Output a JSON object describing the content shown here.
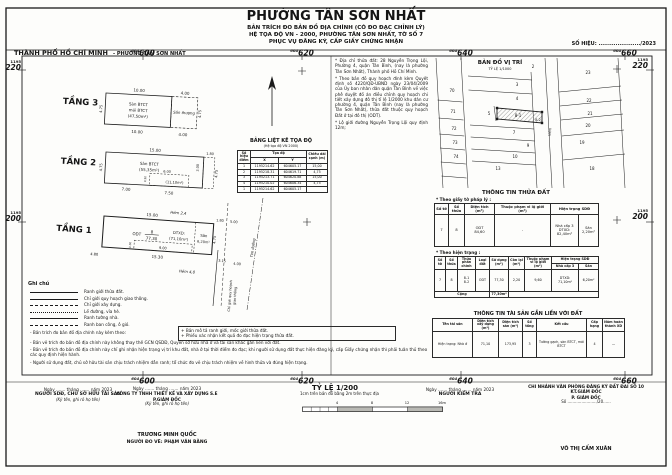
{
  "header": {
    "ward_title": "PHƯỜNG TÂN SƠN NHẤT",
    "subtitle1": "BẢN TRÍCH ĐO BẢN ĐỒ ĐỊA CHÍNH (CÓ ĐO ĐẠC CHỈNH LÝ)",
    "subtitle2": "HỆ TỌA ĐỘ VN - 2000, PHƯỜNG TÂN SƠN NHẤT, TỜ SỐ 7",
    "subtitle3": "PHỤC VỤ ĐĂNG KÝ, CẤP GIẤY CHỨNG NHẬN",
    "city": "THÀNH PHỐ HỒ CHÍ MINH",
    "city_suffix": "-  PHƯỜNG TÂN SƠN NHẤT",
    "doc_no": "SỐ HIỆU: ....................../2023"
  },
  "frame": {
    "tick_prefix": "604",
    "ticks": [
      "600",
      "620",
      "640",
      "660"
    ],
    "row_prefix": "1195",
    "rows": [
      "220",
      "200"
    ]
  },
  "floors": {
    "f3": {
      "label": "TẦNG 3",
      "l1": "Sàn BTCT",
      "l2": "mái BTCT",
      "l3": "(47,50m²)",
      "annex": "Sân thượng",
      "d_top1": "10.00",
      "d_top2": "4.00",
      "d_bot1": "10.00",
      "d_bot2": "4.00",
      "d_left": "4.75",
      "d_right": "4.75"
    },
    "f2": {
      "label": "TẦNG 2",
      "l1": "Sàn BTCT",
      "l2": "(55,35m²)",
      "void_area": "(11,10m²)",
      "d_top": "15.00",
      "d_top2": "1.80",
      "d_void": "6.00",
      "d_bot1": "7.00",
      "d_bot2": "7.50",
      "d_left": "4.75",
      "d_right": "4.75",
      "d_r2": "3.00",
      "d_small": "0.30"
    },
    "f1": {
      "label": "TẦNG 1",
      "odt": "ODT",
      "lot_no": "8",
      "lot_area": "77,30",
      "dtxd1": "DTXD:",
      "dtxd2": "(71,10m²)",
      "san1": "Sân",
      "san2": "6,20m²",
      "d_top": "15.00",
      "d_top2": "1.80",
      "d_top3": "5.00",
      "d_bot0": "4.80",
      "d_bot1": "15.30",
      "d_bot2": "3.15",
      "d_bot3": "4.00",
      "d_right": "4.75",
      "d_in": "9.00",
      "d_in2": "0.30",
      "alley_top": "Hẻm 2,4",
      "alley_bot": "Hẻm 4,0",
      "cgqh1": "Chỉ giới quy hoạch",
      "cgqh2": "giao thông",
      "tim": "Tim đường"
    }
  },
  "coord_table": {
    "title": "BẢNG LIỆT KÊ TỌA ĐỘ",
    "subtitle": "(Hệ tọa độ VN 2000)",
    "h_point": "Số hiệu điểm",
    "h_coord": "Tọa độ",
    "h_x": "X",
    "h_y": "Y",
    "h_len": "Chiều dài cạnh (m)",
    "rows": [
      [
        "1",
        "1195214.62",
        "604605.17",
        "15,00"
      ],
      [
        "2",
        "1195218.31",
        "604619.71",
        "4,75"
      ],
      [
        "3",
        "1195213.71",
        "604620.88",
        "15,00"
      ],
      [
        "4",
        "1195210.02",
        "604606.34",
        "4,75"
      ],
      [
        "1",
        "1195214.62",
        "604605.17",
        ""
      ]
    ]
  },
  "notes_right": {
    "n1": "* Địa chỉ thửa đất: 28 Nguyễn Trọng Lội, Phường 4, quận Tân Bình, (nay là phường Tân Sơn Nhất), Thành phố Hồ Chí Minh.",
    "n2": "* Theo bản đồ quy hoạch đính kèm Quyết định số 4220/QĐ-UBND ngày 23/04/2009 của Ủy ban nhân dân quận Tân Bình về việc phê duyệt đồ án điều chỉnh quy hoạch chi tiết xây dựng đô thị tỉ lệ 1/2000 khu dân cư phường 4, quận Tân Bình (nay là phường Tân Sơn Nhất), thửa đất thuộc quy hoạch Đất ở tại đô thị (ODT).",
    "n3": "* Lộ giới đường Nguyễn Trọng Lội quy định 12m;"
  },
  "location_map": {
    "title": "BẢN ĐỒ VỊ TRÍ",
    "scale": "TỶ LỆ 1/1000",
    "street": "Hẻm",
    "parcels": {
      "p2": "2",
      "p3": "3",
      "p4": "4",
      "p5": "5",
      "p81": "8-1",
      "p82": "8-2",
      "p7": "7",
      "p9": "9",
      "p10": "10",
      "p13": "13",
      "p70": "70",
      "p71": "71",
      "p72": "72",
      "p73": "73",
      "p74": "74",
      "p23": "23",
      "p22": "22",
      "p21": "21",
      "p20": "20",
      "p19": "19",
      "p18": "18"
    }
  },
  "land_info": {
    "title": "THÔNG TIN THỬA ĐẤT",
    "legal_caption": "* Theo giấy tờ pháp lý :",
    "legal": {
      "headers": [
        "Số tờ",
        "Số thửa",
        "Diện tích (m²)",
        "Thuộc phạm vi lộ giới (m²)",
        "Hiện trạng SDĐ"
      ],
      "so_to": "7",
      "so_thua": "8",
      "loai": "ODT",
      "dien_tich": "84,60",
      "lo_gioi": "-",
      "ht_nha": "Nhà cấp 3\nDTXD:\n82,40m²",
      "ht_san": "Sân\n2,20m²"
    },
    "current_caption": "* Theo hiện trạng :",
    "current": {
      "h_so_to": "Số tờ",
      "h_so_thua": "Số thửa",
      "h_phan": "Thửa phân chính",
      "h_loai": "Loại đất",
      "h_su_dung": "Sử dụng (m²)",
      "h_con_lai": "Còn lại (m²)",
      "h_lo_gioi": "Thuộc phạm vi lộ giới (m²)",
      "h_ht": "Hiện trạng SDĐ",
      "h_nha": "Nhà cấp 3",
      "h_san": "Sân",
      "so_to": "7",
      "so_thua": "8",
      "phan": "8-1\n8-2",
      "loai": "ODT",
      "su_dung": "77,30",
      "con_lai": "2,20",
      "lo_gioi": "9,60",
      "ht_nha": "DTXD:\n71,10m²",
      "ht_san": "6,20m²",
      "total_label": "Cộng",
      "total_value": "77,30m²"
    }
  },
  "asset_info": {
    "title": "THÔNG TIN TÀI SẢN GẮN LIỀN VỚI ĐẤT",
    "headers": [
      "Tên tài sản",
      "Diện tích xây dựng (m²)",
      "Diện tích sàn (m²)",
      "Số tầng",
      "Kết cấu",
      "Cấp hạng",
      "Năm hoàn thành XD"
    ],
    "row": [
      "Hiện trạng: Nhà ở",
      "71,10",
      "173,95",
      "3",
      "Tường gạch, sàn BTCT, mái BTCT",
      "4",
      "—"
    ]
  },
  "legend": {
    "title": "Ghi chú",
    "items": [
      {
        "label": "Ranh giới thửa đất."
      },
      {
        "label": "Chỉ giới quy hoạch giao thông."
      },
      {
        "label": "Chỉ giới xây dựng."
      },
      {
        "label": "Lề đường, vỉa hè."
      },
      {
        "label": "Ranh tường nhà."
      },
      {
        "label": "Ranh ban công, ô gió."
      }
    ]
  },
  "notes_bottom": {
    "n1": "- Bản trích đo bản đồ địa chính này kèm theo:",
    "n1a": "+ Bản mô tả ranh giới, mốc giới thửa đất.",
    "n1b": "+ Phiếu xác nhận kết quả đo đạc hiện trạng thửa đất.",
    "n2": "- Bản vẽ trích đo bản đồ địa chính này không thay thế GCN QSDĐ, Quyền sở hữu nhà ở và tài sản khác gắn liền với đất.",
    "n3": "- Bản vẽ trích đo bản đồ địa chính này chỉ ghi nhận hiện trạng vị trí khu đất, nhà ở tại thời điểm đo đạc; khi người sử dụng đất thực hiện đăng ký, cấp Giấy chứng nhận thì phải tuân thủ theo các quy định hiện hành.",
    "n4": "- Người sử dụng đất, chủ sở hữu tài sản chịu trách nhiệm dẫn ranh; tổ chức đo vẽ chịu trách nhiệm về hình thửa và đúng hiện trạng."
  },
  "signatures": {
    "date1": "Ngày ....... tháng ....... năm 2023",
    "b1_title": "NGƯỜI SDĐ, CHỦ SỞ HỮU TÀI SẢN",
    "b1_sub": "(Ký tên, ghi rõ họ tên)",
    "date2": "Ngày ....... tháng ....... năm 2023",
    "b2_title": "CÔNG TY TNHH THIẾT KẾ VÀ XÂY DỰNG S.E",
    "b2_role": "P.GIÁM ĐỐC",
    "b2_sub": "(Ký tên, ghi rõ họ tên)",
    "b2_name": "TRƯƠNG MINH QUỐC",
    "b2_surveyor": "NGƯỜI ĐO VẼ: PHẠM VĂN BẰNG",
    "date3": "Ngày ....... tháng ....... năm 2023",
    "b3_title": "NGƯỜI KIỂM TRA",
    "b4_org": "CHI NHÁNH VĂN PHÒNG ĐĂNG KÝ ĐẤT ĐAI SỐ 10",
    "b4_role1": "KT.GIÁM ĐỐC",
    "b4_role2": "P. GIÁM ĐỐC",
    "b4_no": "Số ......................./20......",
    "b4_name": "VÕ THỊ CẨM XUÂN"
  },
  "scale_block": {
    "title": "TỶ LỆ 1/200",
    "subtitle": "1cm trên bản đồ bằng 2m trên thực địa",
    "t1": "4",
    "t2": "8",
    "t3": "12",
    "t4": "16m"
  }
}
